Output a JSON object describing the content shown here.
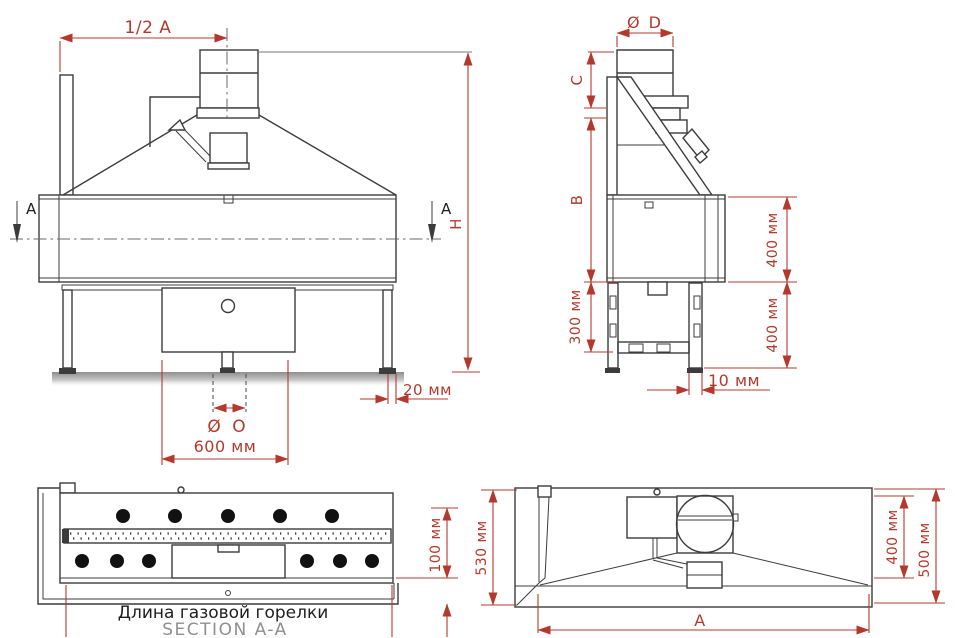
{
  "views": {
    "front": {
      "half_width": "1/2 A",
      "section_marker_left": "A",
      "section_marker_right": "A",
      "overall_height": "H",
      "leg_inset": "20 мм",
      "pipe_diameter": "Ø O",
      "burner_box_width": "600 мм"
    },
    "side": {
      "flue_diameter": "Ø D",
      "dim_c": "C",
      "dim_b": "B",
      "lower_frame_height": "300 мм",
      "body_height": "400 мм",
      "leg_height": "400 мм",
      "leg_offset": "10 мм"
    },
    "section_aa": {
      "burner_depth": "100 мм",
      "caption_primary": "Длина газовой горелки",
      "caption_secondary": "SECTION A-A"
    },
    "top": {
      "depth_total": "530 мм",
      "hood_depth": "400 мм",
      "depth_inner": "500 мм",
      "width_label": "A",
      "width_extra_partial": "+ 100"
    }
  },
  "colors": {
    "drawing_line": "#3c3c3c",
    "dimension_red": "#b4392c",
    "caption_gray": "#8f8f8f",
    "text_black": "#1e1e1e"
  }
}
